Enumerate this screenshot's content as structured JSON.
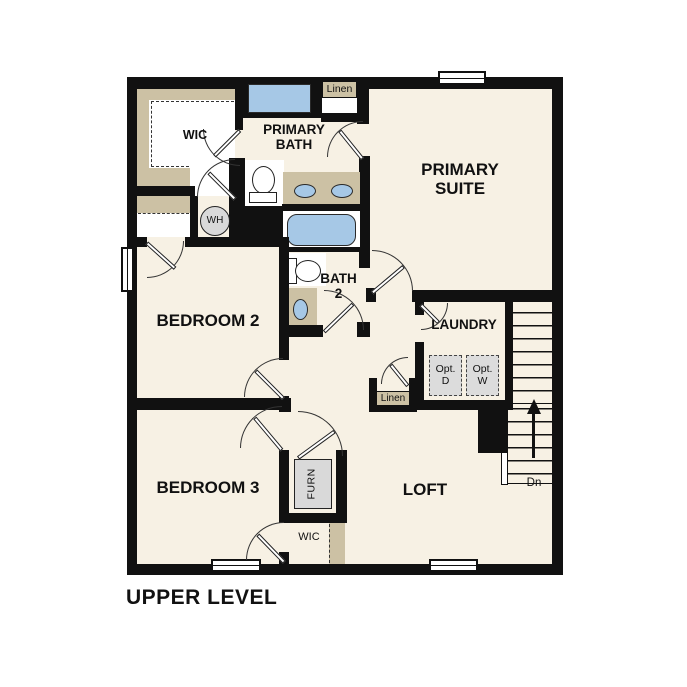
{
  "plan": {
    "title": "UPPER LEVEL",
    "level": "Upper Level floor plan"
  },
  "labels": {
    "wic_upper": "WIC",
    "primary_bath": "PRIMARY BATH",
    "linen_upper": "Linen",
    "primary_suite": "PRIMARY SUITE",
    "water_heater": "WH",
    "bedroom_2": "BEDROOM 2",
    "bath_2": "BATH 2",
    "laundry": "LAUNDRY",
    "opt_dryer": "Opt. D",
    "opt_washer": "Opt. W",
    "linen_hall": "Linen",
    "bedroom_3": "BEDROOM 3",
    "furnace": "FURN",
    "loft": "LOFT",
    "wic_lower": "WIC",
    "stairs_down": "Dn"
  },
  "colors": {
    "wall": "#111111",
    "floor": "#F7F1E4",
    "casework_tan": "#CCC1A4",
    "fixture_blue": "#A6C8E6",
    "appliance_gray": "#DCDCDC",
    "background": "#FFFFFF"
  }
}
